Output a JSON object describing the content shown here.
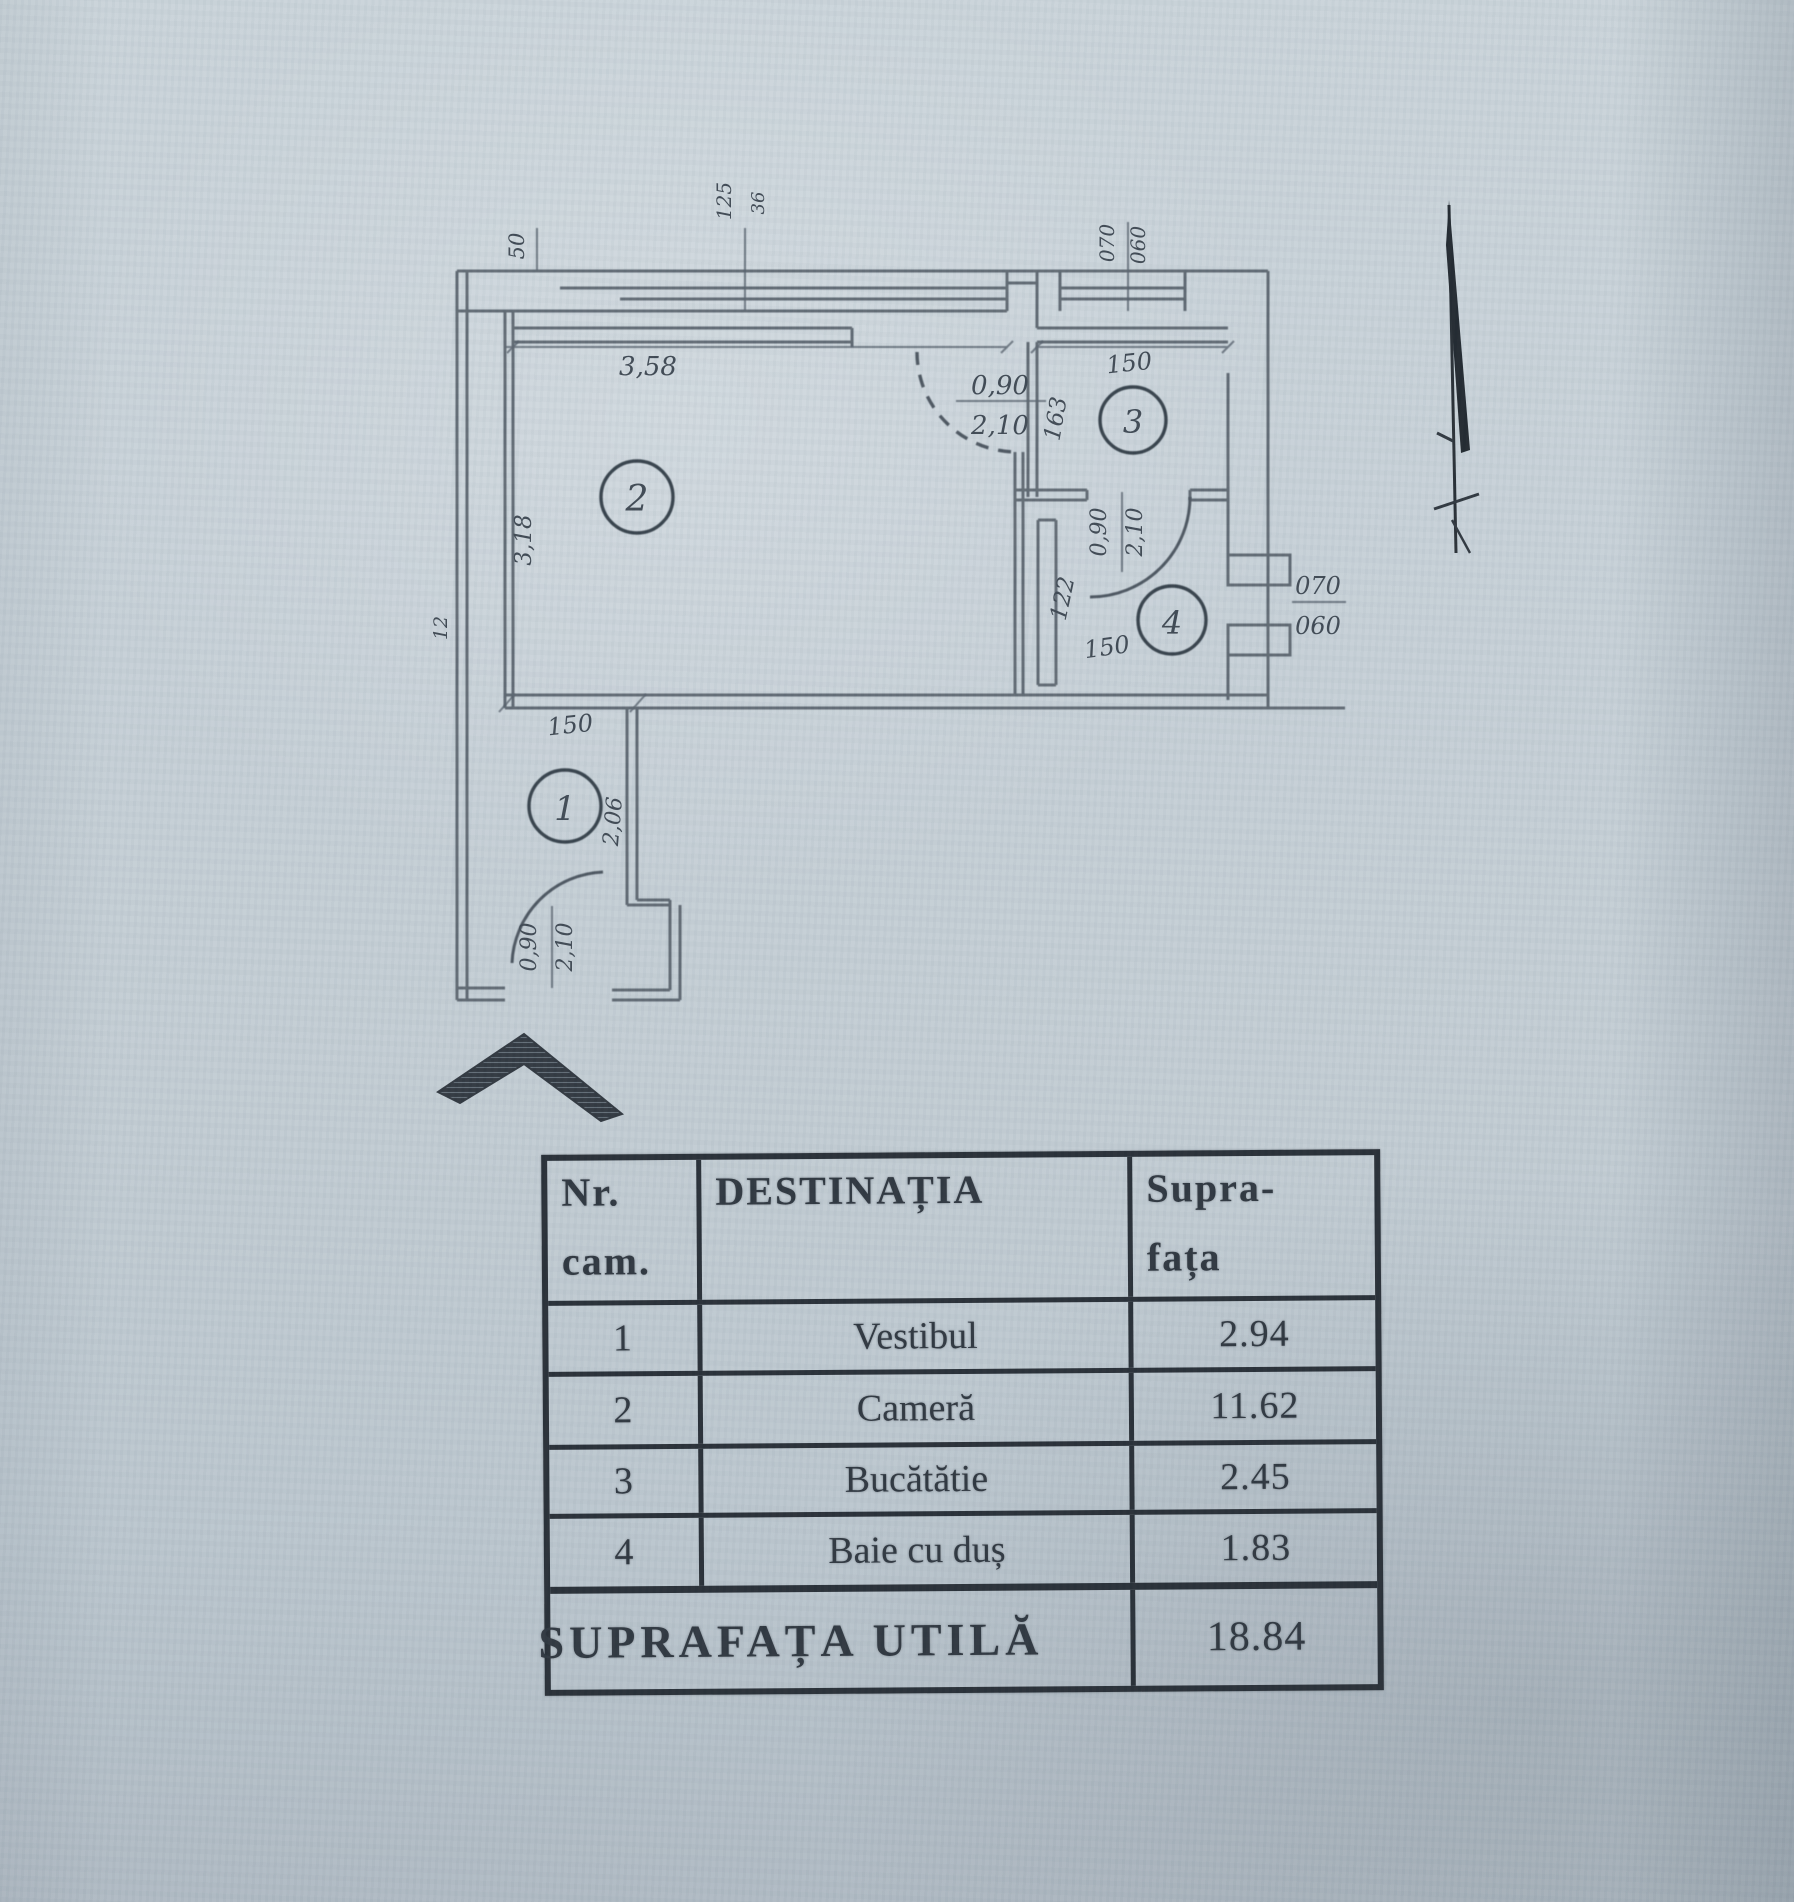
{
  "plan": {
    "room_numbers": {
      "r1": "1",
      "r2": "2",
      "r3": "3",
      "r4": "4"
    },
    "dims": {
      "wall_seg": "50",
      "win_main_a": "125",
      "win_main_b": "36",
      "room2_w": "3,58",
      "room2_h": "3,18",
      "wall_t": "12",
      "kitchen_w": "150",
      "kitchen_h": "163",
      "win_kitchen_a": "070",
      "win_kitchen_b": "060",
      "bath_w": "150",
      "bath_h": "122",
      "win_bath_a": "070",
      "win_bath_b": "060",
      "vest_w": "150",
      "vest_h": "2,06"
    },
    "doors": {
      "kitchen": {
        "w": "0,90",
        "h": "2,10"
      },
      "bath": {
        "w": "0,90",
        "h": "2,10"
      },
      "entry": {
        "w": "0,90",
        "h": "2,10"
      }
    }
  },
  "table": {
    "header": {
      "col1_line1": "Nr.",
      "col1_line2": "cam.",
      "col2": "DESTINAȚIA",
      "col3_line1": "Supra-",
      "col3_line2": "fața"
    },
    "rows": [
      {
        "nr": "1",
        "destination": "Vestibul",
        "area": "2.94"
      },
      {
        "nr": "2",
        "destination": "Cameră",
        "area": "11.62"
      },
      {
        "nr": "3",
        "destination": "Bucătătie",
        "area": "2.45"
      },
      {
        "nr": "4",
        "destination": "Baie cu duș",
        "area": "1.83"
      }
    ],
    "footer": {
      "label": "SUPRAFAȚA UTILĂ",
      "value": "18.84"
    }
  }
}
